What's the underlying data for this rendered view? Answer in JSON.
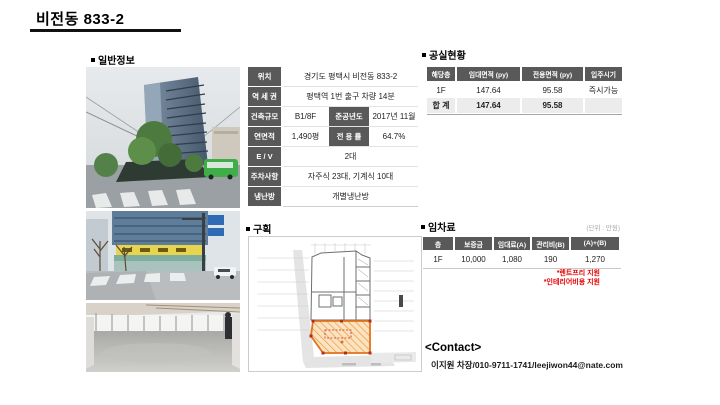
{
  "page": {
    "title": "비전동 833-2"
  },
  "sections": {
    "general_label": "일반정보",
    "vacancy_label": "공실현황",
    "plan_label": "구획",
    "rent_label": "임차료",
    "rent_unit_note": "(단위 : 만원)"
  },
  "general_info": {
    "rows": [
      {
        "label": "위치",
        "value": "경기도 평택시 비전동 833-2"
      },
      {
        "label": "역 세 권",
        "value": "평택역 1번 출구 차량 14분"
      },
      {
        "label": "건축규모",
        "value": "B1/8F",
        "sub_label": "준공년도",
        "sub_value": "2017년 11월"
      },
      {
        "label": "연면적",
        "value": "1,490평",
        "sub_label": "전 용 률",
        "sub_value": "64.7%"
      },
      {
        "label": "E / V",
        "value": "2대"
      },
      {
        "label": "주차사항",
        "value": "자주식 23대, 기계식 10대"
      },
      {
        "label": "냉난방",
        "value": "개별냉난방"
      }
    ]
  },
  "vacancy_table": {
    "headers": [
      "해당층",
      "임대면적 (py)",
      "전용면적 (py)",
      "입주시기"
    ],
    "rows": [
      {
        "floor": "1F",
        "lease_area": "147.64",
        "exclusive_area": "95.58",
        "move_in": "즉시가능"
      },
      {
        "floor": "합 계",
        "lease_area": "147.64",
        "exclusive_area": "95.58",
        "move_in": ""
      }
    ]
  },
  "rent_table": {
    "headers": [
      "층",
      "보증금",
      "임대료(A)",
      "관리비(B)",
      "(A)+(B)"
    ],
    "rows": [
      {
        "floor": "1F",
        "deposit": "10,000",
        "rent": "1,080",
        "maintenance": "190",
        "total": "1,270"
      }
    ],
    "notes": [
      "*렌트프리 지원",
      "*인테리어비용 지원"
    ]
  },
  "contact": {
    "heading": "<Contact>",
    "line": "이지원 차장/010-9711-1741/leejiwon44@nate.com"
  },
  "photos": {
    "photo1_alt": "building-exterior",
    "photo2_alt": "street-corner-view",
    "photo3_alt": "empty-interior"
  },
  "colors": {
    "table_header_bg": "#595959",
    "total_row_bg": "#ececec",
    "note_red": "#e60000",
    "plan_highlight_fill": "#fbe3c0",
    "plan_highlight_border": "#e2711d"
  }
}
